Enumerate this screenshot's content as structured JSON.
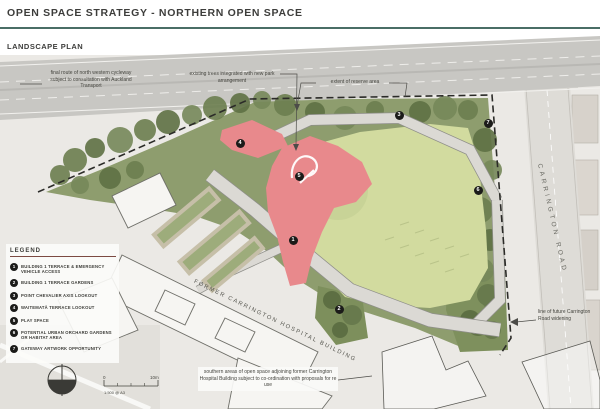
{
  "page": {
    "title": "OPEN SPACE STRATEGY - NORTHERN OPEN SPACE",
    "subtitle": "LANDSCAPE PLAN"
  },
  "annotations": {
    "cycleway": "final route of north western cycleway subject to consultation with Auckland Transport",
    "existing_trees": "existing trees integrated with new park arrangement",
    "reserve_extent": "extent of reserve area",
    "road_widening": "line of future Carrington Road widening",
    "southern_areas": "southern areas of open space adjoining former Carrington Hospital Building subject to co-ordination with proposals for re use"
  },
  "map_labels": {
    "carrington_road": "CARRINGTON ROAD",
    "former_hospital": "FORMER CARRINGTON HOSPITAL BUILDING"
  },
  "legend": {
    "title": "LEGEND",
    "items": [
      {
        "num": "1",
        "label": "BUILDING 1 TERRACE & EMERGENCY VEHICLE ACCESS"
      },
      {
        "num": "2",
        "label": "BUILDING 1 TERRACE GARDENS"
      },
      {
        "num": "3",
        "label": "POINT CHEVALIER AXIS LOOKOUT"
      },
      {
        "num": "4",
        "label": "WAITEMATĀ TERRACE LOOKOUT"
      },
      {
        "num": "5",
        "label": "PLAY SPACE"
      },
      {
        "num": "6",
        "label": "POTENTIAL URBAN ORCHARD GARDENS OR HABITAT AREA"
      },
      {
        "num": "7",
        "label": "GATEWAY ARTWORK OPPORTUNITY"
      }
    ]
  },
  "markers": [
    {
      "num": "1",
      "x": 293,
      "y": 240
    },
    {
      "num": "2",
      "x": 339,
      "y": 309
    },
    {
      "num": "3",
      "x": 399,
      "y": 115
    },
    {
      "num": "4",
      "x": 240,
      "y": 143
    },
    {
      "num": "5",
      "x": 299,
      "y": 176
    },
    {
      "num": "6",
      "x": 478,
      "y": 190
    },
    {
      "num": "7",
      "x": 488,
      "y": 123
    }
  ],
  "scalebar": {
    "start": "0",
    "end": "10m",
    "ratio": "1:500 @ A3"
  },
  "colors": {
    "accent_rule": "#4a6e66",
    "legend_rule": "#7c4a42",
    "park_green": "#8e9d6e",
    "lawn_green": "#d2db9f",
    "play_pink": "#e8898c",
    "marker_black": "#1b1b19"
  }
}
